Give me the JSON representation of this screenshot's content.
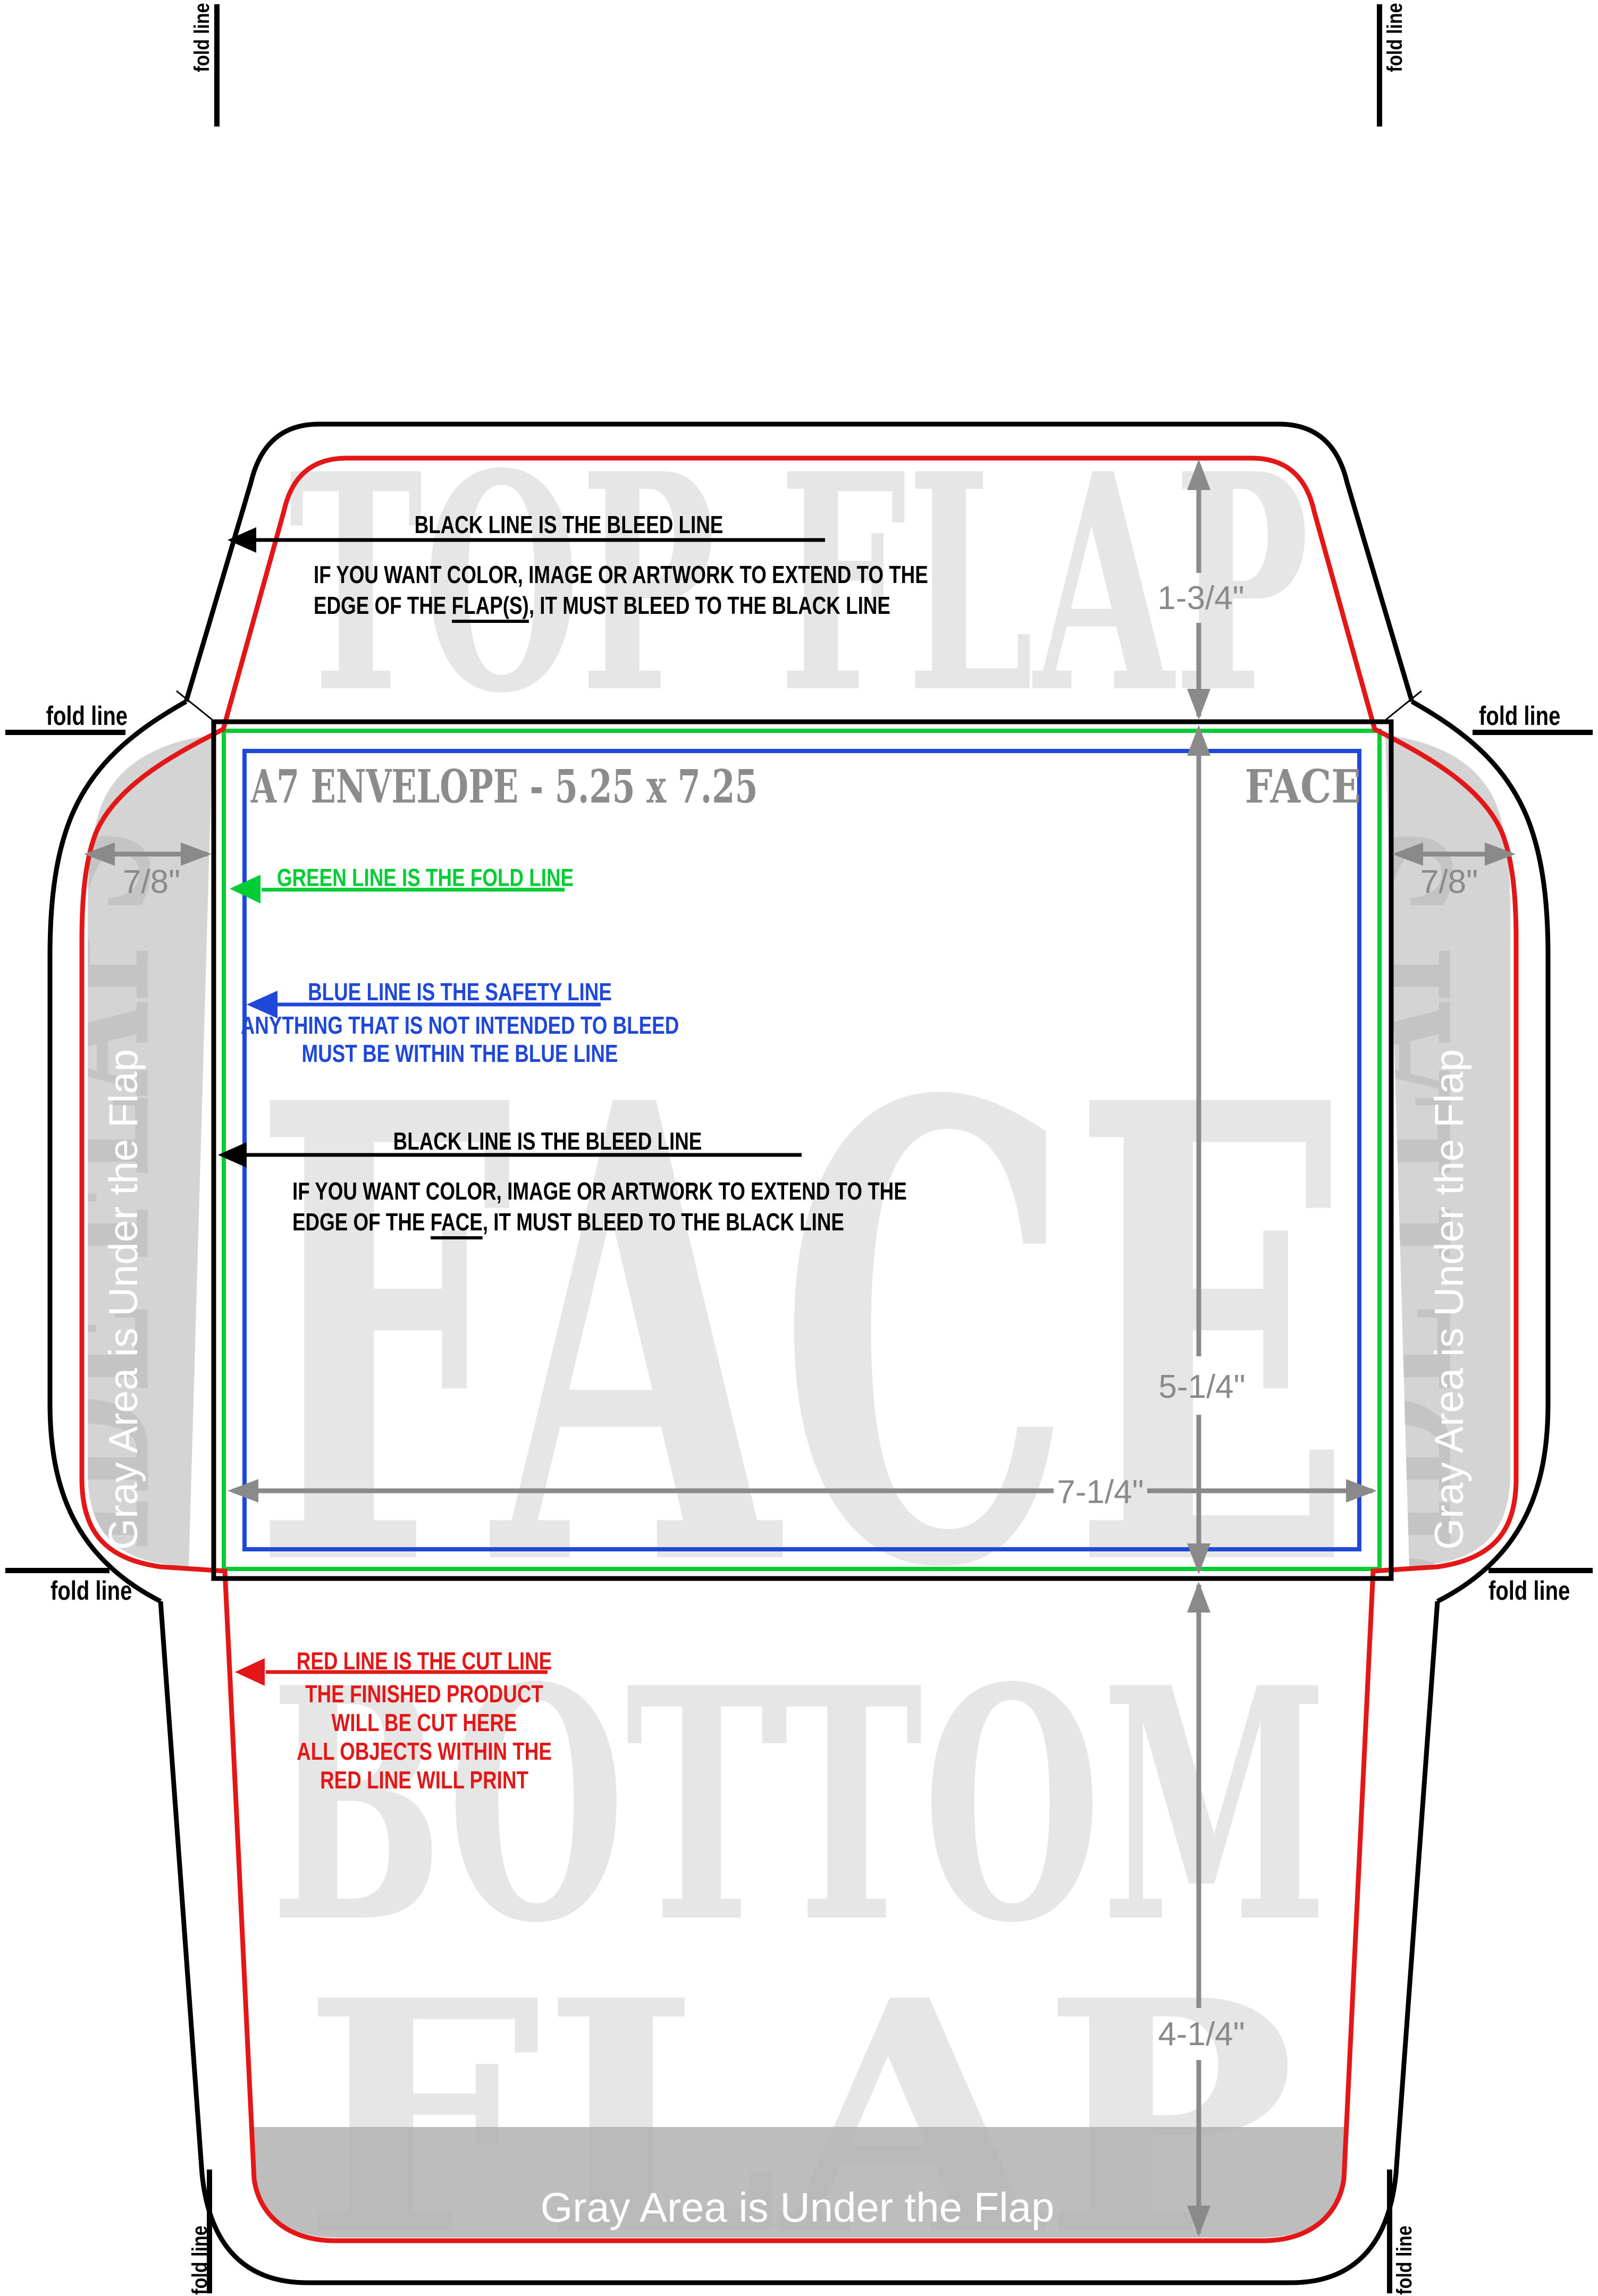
{
  "title": {
    "name": "A7 ENVELOPE - 5.25 x 7.25",
    "face_label": "FACE"
  },
  "fold_line_label": "fold line",
  "gray_area_note": "Gray Area is Under the Flap",
  "watermarks": {
    "top_flap": "TOP FLAP",
    "face": "FACE",
    "side_flaps": "SIDE FLAPS",
    "bottom_flap_line1": "BOTTOM",
    "bottom_flap_line2": "FLAP"
  },
  "dimensions": {
    "top_flap_height": "1-3/4\"",
    "side_flap_width": "7/8\"",
    "face_height": "5-1/4\"",
    "face_width": "7-1/4\"",
    "bottom_flap_height": "4-1/4\""
  },
  "annotations": {
    "flap_bleed": {
      "line1": "BLACK LINE IS THE BLEED LINE",
      "line2": "IF YOU WANT COLOR, IMAGE OR ARTWORK TO EXTEND TO THE",
      "line3_prefix": "EDGE OF THE ",
      "line3_underline": "FLAP(S)",
      "line3_suffix": ", IT MUST BLEED TO THE BLACK LINE"
    },
    "fold": {
      "line1": "GREEN LINE IS THE FOLD LINE"
    },
    "safety": {
      "line1": "BLUE LINE IS THE SAFETY LINE",
      "line2": "ANYTHING THAT IS NOT INTENDED TO BLEED",
      "line3": "MUST BE WITHIN THE BLUE LINE"
    },
    "face_bleed": {
      "line1": "BLACK LINE IS THE BLEED LINE",
      "line2": "IF YOU WANT COLOR, IMAGE OR ARTWORK TO EXTEND TO THE",
      "line3_prefix": "EDGE OF THE ",
      "line3_underline": "FACE",
      "line3_suffix": ", IT MUST BLEED TO THE BLACK LINE"
    },
    "cut": {
      "line1": "RED LINE IS THE CUT LINE",
      "line2": "THE FINISHED PRODUCT",
      "line3": "WILL BE CUT HERE",
      "line4": "ALL OBJECTS WITHIN THE",
      "line5": "RED LINE WILL PRINT"
    }
  },
  "colors": {
    "cut_red": "#e31717",
    "fold_green": "#00cc33",
    "safety_blue": "#2048d8",
    "dimension_gray": "#8a8a8a",
    "title_gray": "#8c8c8c",
    "watermark_gray": "#e6e6e6",
    "flap_gray": "#d4d4d4",
    "side_watermark_gray": "#c4c4c4",
    "band_gray": "#b0b0b0",
    "black": "#000000",
    "white": "#ffffff"
  }
}
